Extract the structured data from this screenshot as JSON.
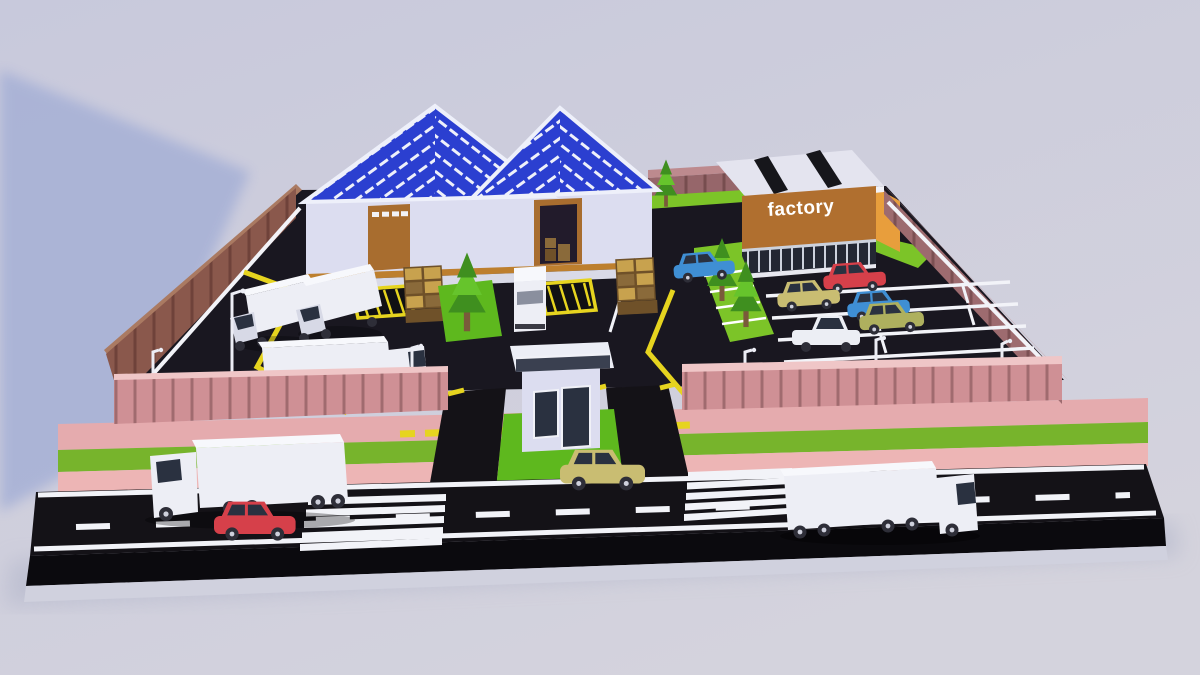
{
  "factory_sign": {
    "label": "factory"
  },
  "scene": {
    "description": "low-poly 3D rendered diorama of a fenced factory yard",
    "inventory": [
      "warehouse with two gabled solar-panel roofs",
      "factory office building with sign",
      "guard house at gate",
      "perimeter fence (pink front, brown left, mauve right)",
      "parking lot with red, khaki, blue, olive cars and white pickup",
      "yard with box trucks, semi truck, delivery van, crate stacks, loading pads",
      "street with semi trucks, red car, khaki car, crosswalks",
      "low-poly trees and street lights"
    ]
  },
  "palette": {
    "bg1": "#c8c9dc",
    "bg2": "#d4d3dd",
    "shadow": "#a6b0d6",
    "ground_shadow": "#b4b7cb",
    "road": "#141217",
    "road_face": "#0b0a0e",
    "plinth": "#d0d1de",
    "asphalt": "#191720",
    "white": "#f2f3f8",
    "pink1": "#e5abae",
    "pink2": "#edb5b5",
    "green_band": "#77b42c",
    "fence_pink": "#cf9095",
    "fence_pink_top": "#efc6c7",
    "fence_left": "#8a584c",
    "fence_left_top": "#aa7a62",
    "fence_right": "#9d6b6f",
    "fence_right_top": "#bd8a8e",
    "fence_back": "#96666a",
    "wall": "#dcddf0",
    "trim": "#bd7f2e",
    "apron": "#d9dae7",
    "roof_blue": "#2b3fd0",
    "roof_white": "#eef0fa",
    "door": "#a86d2f",
    "door_dark": "#221b2b",
    "f_orange": "#b06f2f",
    "f_side": "#e89e3c",
    "f_roof": "#e4e4ef",
    "skylight": "#16161b",
    "glass": "#232733",
    "mullion": "#ccd1dc",
    "grass": "#7cc428",
    "lawn": "#5eb81e",
    "tree_dark": "#3f8f1f",
    "tree_light": "#66c42c",
    "trunk": "#7a5a3a",
    "yellow": "#e6d41f",
    "crate_top": "#c8a24e",
    "crate_dark": "#6f5129",
    "crate_front": "#8a6a3a",
    "veh_white": "#edeef5",
    "veh_top": "#f7f8fc",
    "veh_shade": "#d7d9e6",
    "wheel": "#2e2e38",
    "hub": "#ced0dc",
    "win": "#2a3140",
    "car_red": "#d6404a",
    "car_khaki": "#c9bd72",
    "car_blue": "#3f8fd4",
    "car_olive": "#aeb05e",
    "car_white": "#eceef4",
    "pole": "#ecedf5"
  }
}
